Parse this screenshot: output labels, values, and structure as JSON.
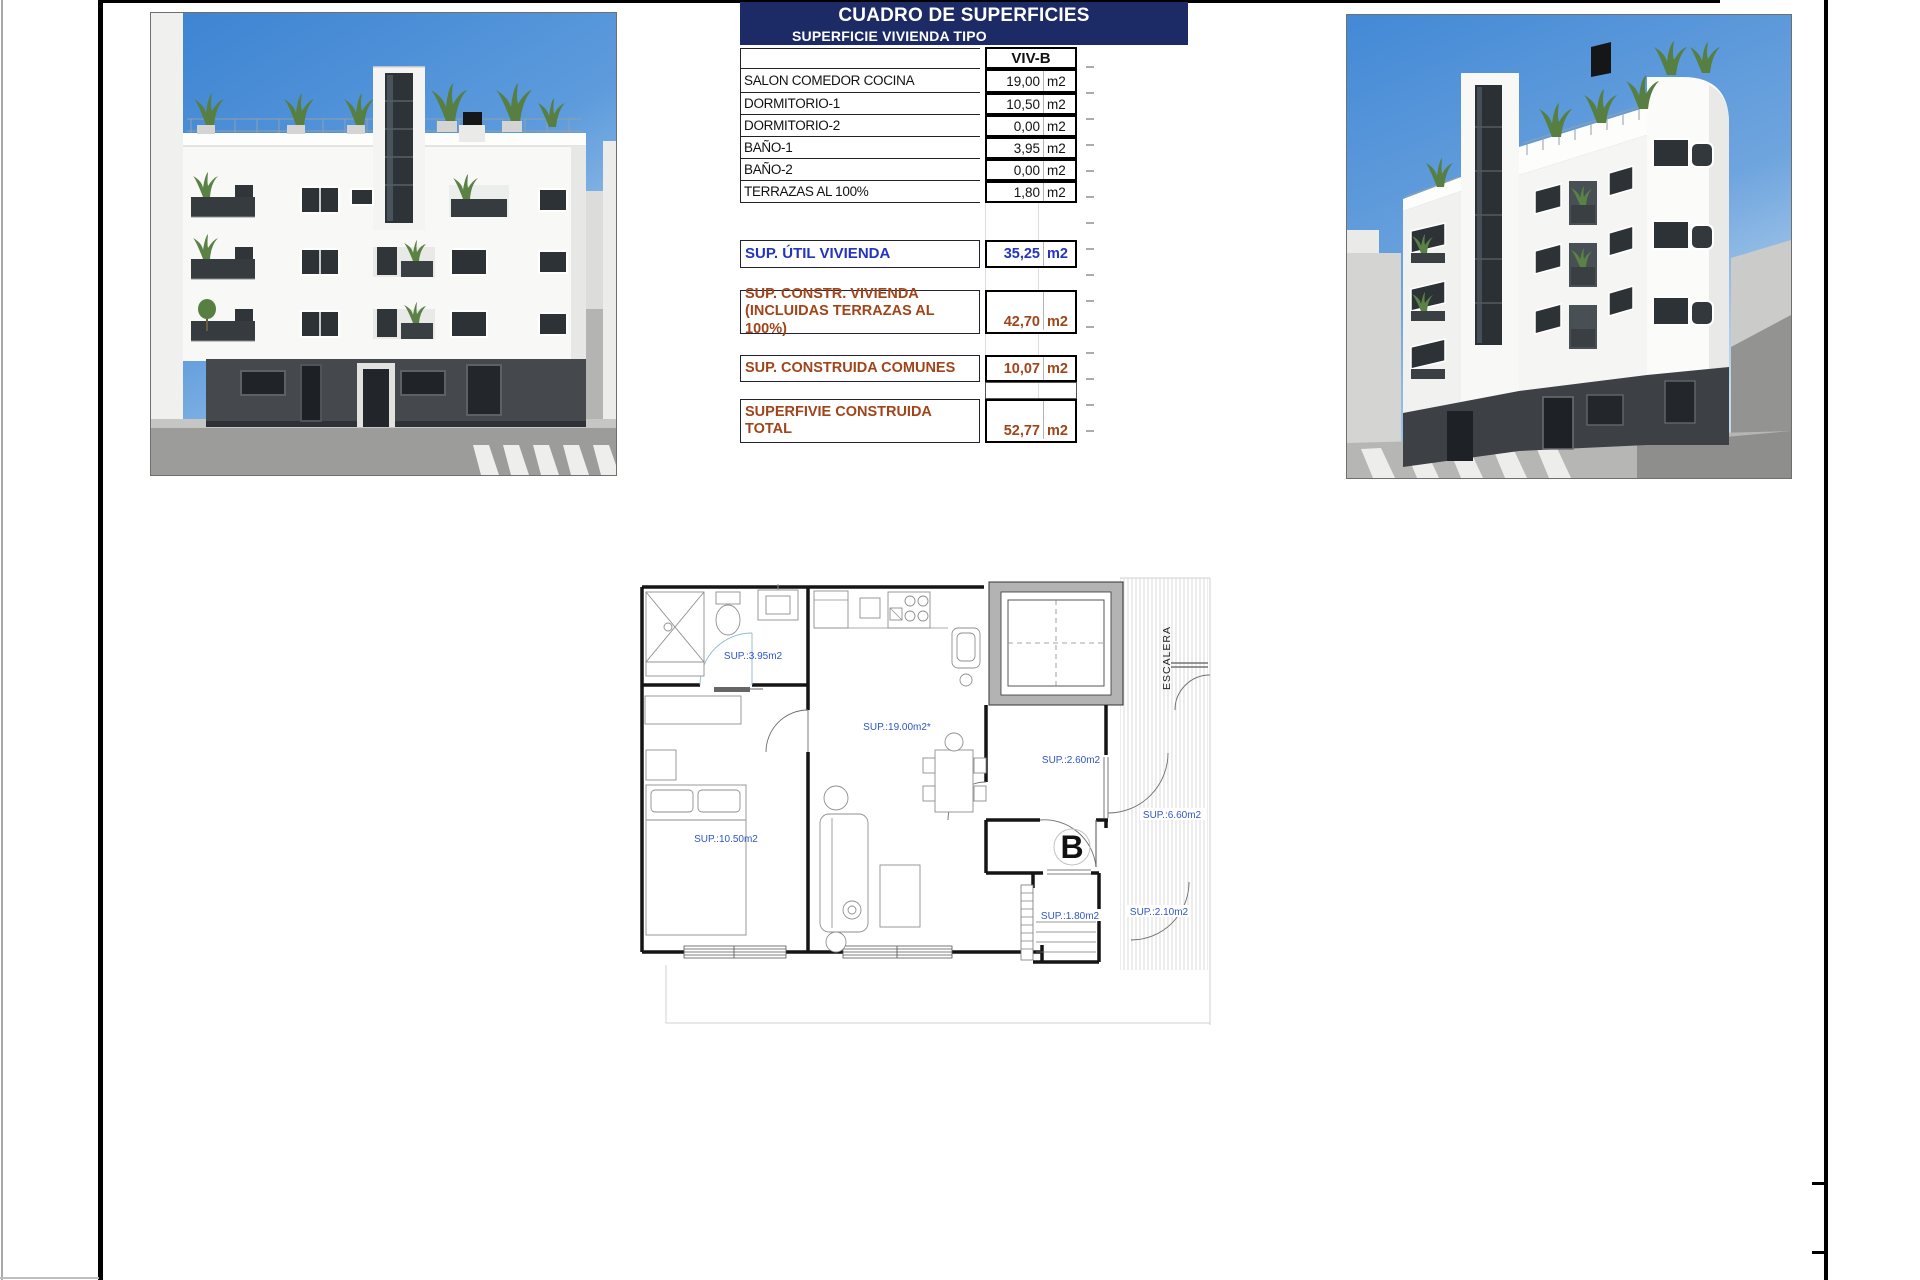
{
  "sheet": {
    "frame_color": "#000000",
    "background": "#ffffff"
  },
  "surface_table": {
    "title": "CUADRO DE SUPERFICIES",
    "subtitle": "SUPERFICIE VIVIENDA TIPO",
    "header_bg": "#1c2a66",
    "column_header": "VIV-B",
    "unit": "m2",
    "rows": [
      {
        "label": "SALON COMEDOR COCINA",
        "value": "19,00"
      },
      {
        "label": "DORMITORIO-1",
        "value": "10,50"
      },
      {
        "label": "DORMITORIO-2",
        "value": "0,00"
      },
      {
        "label": "BAÑO-1",
        "value": "3,95"
      },
      {
        "label": "BAÑO-2",
        "value": "0,00"
      },
      {
        "label": "TERRAZAS AL 100%",
        "value": "1,80"
      }
    ],
    "summary": [
      {
        "label": "SUP. ÚTIL VIVIENDA",
        "label2": "",
        "value": "35,25",
        "color": "#2433c0"
      },
      {
        "label": "SUP. CONSTR. VIVIENDA",
        "label2": "(INCLUIDAS TERRAZAS AL 100%)",
        "value": "42,70",
        "color": "#a1441a"
      },
      {
        "label": "SUP. CONSTRUIDA COMUNES",
        "label2": "",
        "value": "10,07",
        "color": "#a1441a"
      },
      {
        "label": "SUPERFIVIE CONSTRUIDA",
        "label2": "TOTAL",
        "value": "52,77",
        "color": "#a1441a"
      }
    ]
  },
  "floor_plan": {
    "label_color": "#2f55c8",
    "stair_label": "ESCALERA",
    "unit_letter": "B",
    "rooms": [
      {
        "name": "bathroom",
        "label": "SUP.:3.95m2"
      },
      {
        "name": "living-kitchen",
        "label": "SUP.:19.00m2*"
      },
      {
        "name": "bedroom",
        "label": "SUP.:10.50m2"
      },
      {
        "name": "hall",
        "label": "SUP.:2.60m2"
      },
      {
        "name": "landing",
        "label": "SUP.:6.60m2"
      },
      {
        "name": "terrace",
        "label": "SUP.:1.80m2"
      },
      {
        "name": "entry",
        "label": "SUP.:2.10m2"
      }
    ]
  },
  "renders": {
    "left": {
      "name": "building-front-elevation-render"
    },
    "right": {
      "name": "building-corner-perspective-render"
    }
  }
}
